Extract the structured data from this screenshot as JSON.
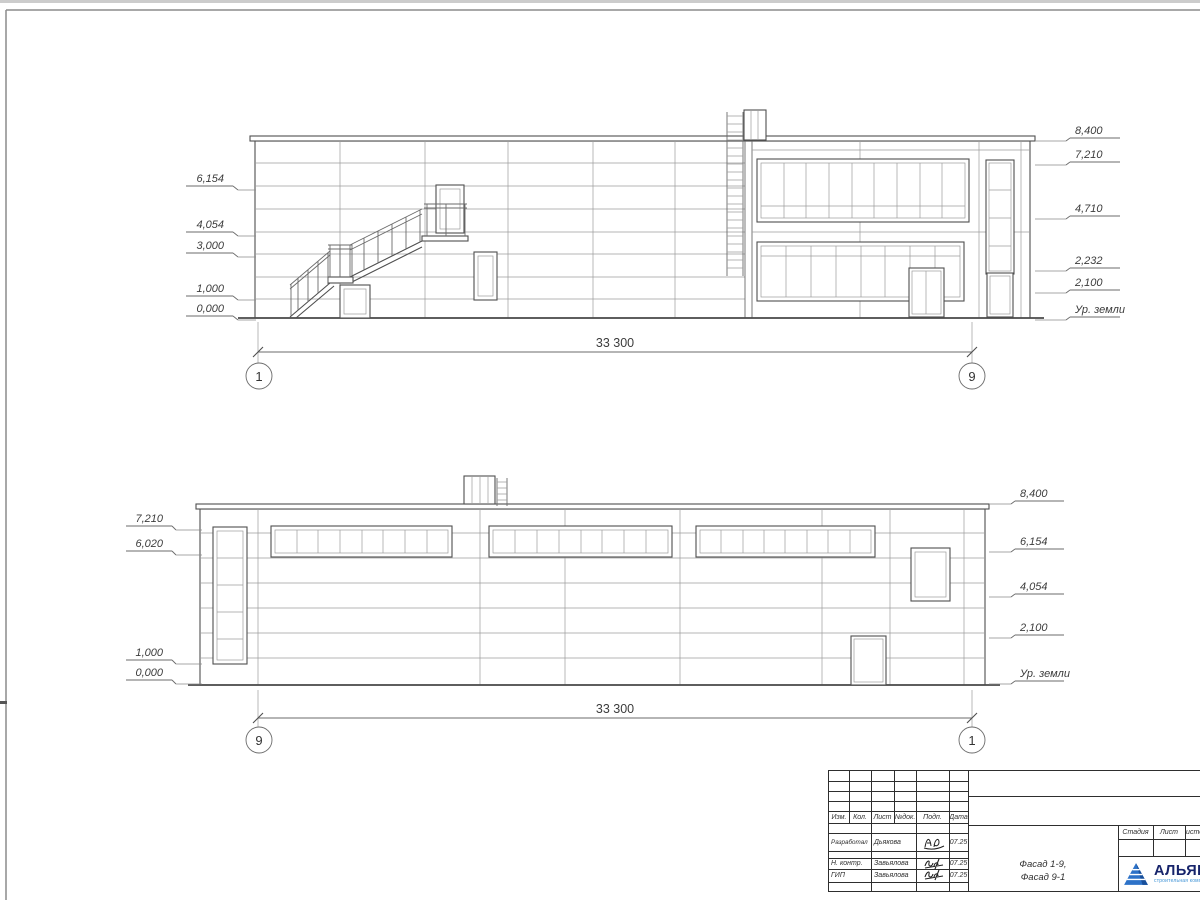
{
  "facade_19": {
    "left_marks": [
      "6,154",
      "4,054",
      "3,000",
      "1,000",
      "0,000"
    ],
    "right_marks": [
      "8,400",
      "7,210",
      "4,710",
      "2,232",
      "2,100",
      "Ур. земли"
    ],
    "dimension": "33 300",
    "axis_left": "1",
    "axis_right": "9"
  },
  "facade_91": {
    "left_marks": [
      "7,210",
      "6,020",
      "1,000",
      "0,000"
    ],
    "right_marks": [
      "8,400",
      "6,154",
      "4,054",
      "2,100",
      "Ур. земли"
    ],
    "dimension": "33 300",
    "axis_left": "9",
    "axis_right": "1"
  },
  "titleblock": {
    "rev_headers": [
      "Изм.",
      "Кол.",
      "Лист",
      "№док.",
      "Подп.",
      "Дата"
    ],
    "rows": [
      {
        "role": "Разработал",
        "name": "Дьякова",
        "date": "07.25"
      },
      {
        "role": "Н. контр.",
        "name": "Завьялова",
        "date": "07.25"
      },
      {
        "role": "ГИП",
        "name": "Завьялова",
        "date": "07.25"
      }
    ],
    "doc_title_line1": "Фасад 1-9,",
    "doc_title_line2": "Фасад 9-1",
    "stage_headers": [
      "Стадия",
      "Лист",
      "Листов"
    ],
    "logo": {
      "name": "АЛЬЯНС",
      "tagline": "строительная компания"
    }
  },
  "colors": {
    "line": "#4f4f4f",
    "thin": "#9c9c9c",
    "logo_blue": "#17246b",
    "logo_light": "#3f93d6"
  }
}
